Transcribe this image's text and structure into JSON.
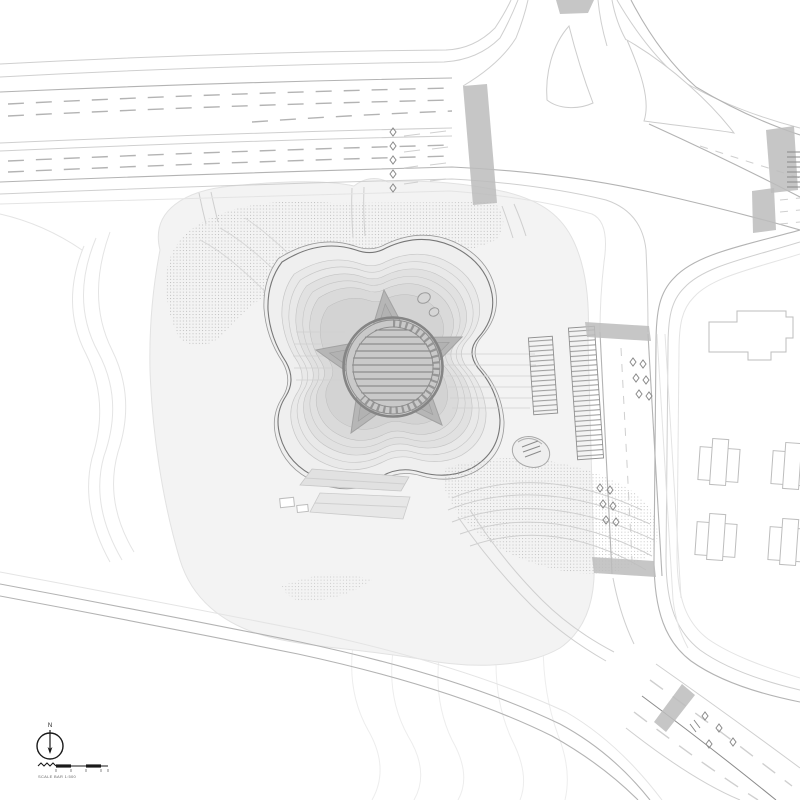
{
  "labels": {
    "north": "N",
    "scale_bar": "SCALE BAR 1:500"
  },
  "colors": {
    "background": "#ffffff",
    "ink": "#1a1a1a",
    "line_faint": "#e4e4e4",
    "line_light": "#cfcfcf",
    "line_mid": "#b3b3b3",
    "line_dark": "#8b8b8b",
    "ground_fill": "#f3f3f3",
    "terrace_fill": "#e2e2e2",
    "star_fill": "#b6b6b6",
    "pavilion_fill": "#c9c9c9",
    "crosswalk_fill": "#bcbcbc"
  }
}
